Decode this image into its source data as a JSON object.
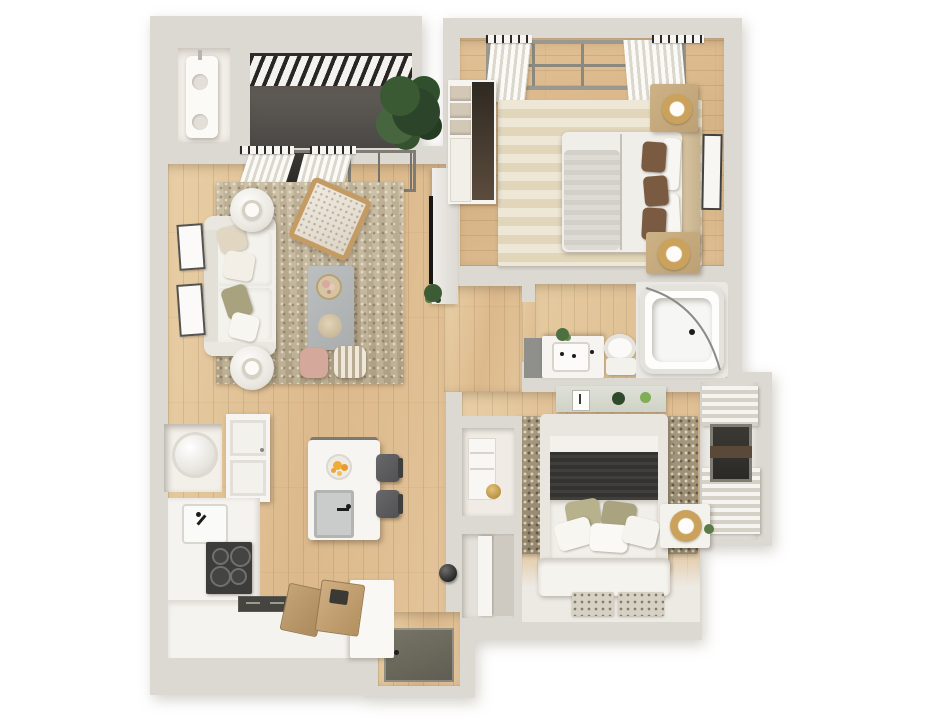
{
  "scene": {
    "type": "3d-floor-plan-render",
    "description": "Top-down photorealistic 3D floor plan of a two-bedroom apartment with balcony, open living/kitchen area, bathroom and entry; beige and white palette on white background",
    "background": "#ffffff"
  },
  "palette": {
    "wall": "#dcd8d2",
    "wall_light": "#efedea",
    "wood_floor": "#dfbf94",
    "wood_floor_light": "#e7cda6",
    "balcony_floor": "#57544f",
    "pergola_slat": "#272624",
    "rug_living": "#c0b498",
    "rug_bedroom1_stripe_a": "#efe7d5",
    "rug_bedroom1_stripe_b": "#e1d5ba",
    "rug_bedroom2": "#9d9075",
    "entry_mat": "#6e6c5e",
    "window_glass": "#33322e",
    "counter_white": "#f5f3ef",
    "cooktop_black": "#3c3c3a",
    "island_white": "#f7f5f1",
    "stool_gray": "#5c5c5a",
    "nightstand_tan": "#c5ab80",
    "pillow_brown": "#7a5b41",
    "pillow_olive": "#b2ac85",
    "throw_dark": "#3a3937",
    "pouf_pink": "#d4a99c",
    "lamp_gold": "#caa25c",
    "plant_green": "#3f5e38",
    "coffee_table_gray": "#b5b8b9",
    "tub_white": "#fdfdfc",
    "console_sage": "#d9dcd2"
  },
  "rooms": {
    "balcony": {
      "name": "Balcony",
      "furniture": {
        "pergola": "Slatted pergola roof",
        "plant": "Potted plant"
      }
    },
    "utility_closet": {
      "name": "Utility closet",
      "furniture": {
        "water_heater": "Water heater"
      }
    },
    "living_room": {
      "name": "Living room",
      "furniture": {
        "sofa": "White sofa with throw pillows",
        "rug": "Textured area rug",
        "coffee_table": "Gray coffee table with decor tray",
        "accent_chair": "Wood-frame accent chair",
        "side_table_top": "Round side table with lamp",
        "side_table_bottom": "Round side table with lamp",
        "pouf_pink": "Blush pouf",
        "pouf_striped": "Striped pouf",
        "tv": "Wall TV panel",
        "art": "Two framed artworks",
        "windows": "Window and balcony door with curtains"
      }
    },
    "kitchen": {
      "name": "Kitchen",
      "furniture": {
        "island": "White island with sink and fruit bowl",
        "stools": "Two bar stools",
        "cooktop": "Four-burner cooktop",
        "sink": "Kitchen sink",
        "counters": "L-shaped counters",
        "upper_cabinet": "Upper cabinet",
        "cutting_boards": "Wooden cutting boards",
        "washer": "Washer in nook"
      }
    },
    "bedroom_1": {
      "name": "Primary bedroom",
      "furniture": {
        "bed": "Double bed with brown pillows",
        "rug": "Striped beige rug",
        "wardrobe": "Wardrobe with drawers",
        "nightstand_top": "Nightstand with gold lamp",
        "nightstand_bottom": "Nightstand with gold lamp",
        "art": "Framed art on wall",
        "window": "Large window with curtains"
      }
    },
    "bathroom": {
      "name": "Bathroom",
      "furniture": {
        "vanity": "Vanity with sink",
        "toilet": "Toilet",
        "bathtub": "Bathtub with curved glass screen"
      }
    },
    "bedroom_2": {
      "name": "Bedroom 2",
      "furniture": {
        "bed": "Platform bed with dark throw",
        "rug": "Speckled rug",
        "console": "Sage console with plants",
        "nightstand": "Nightstand with gold lamp",
        "window": "Bay window with curtains",
        "closets": "Two closets",
        "mats": "Two speckled mats"
      }
    },
    "entry": {
      "name": "Entry",
      "furniture": {
        "mat": "Dark entry mat",
        "door": "Open front door",
        "knob": "Door knob"
      }
    },
    "hallway": {
      "name": "Hallway",
      "furniture": {}
    }
  }
}
